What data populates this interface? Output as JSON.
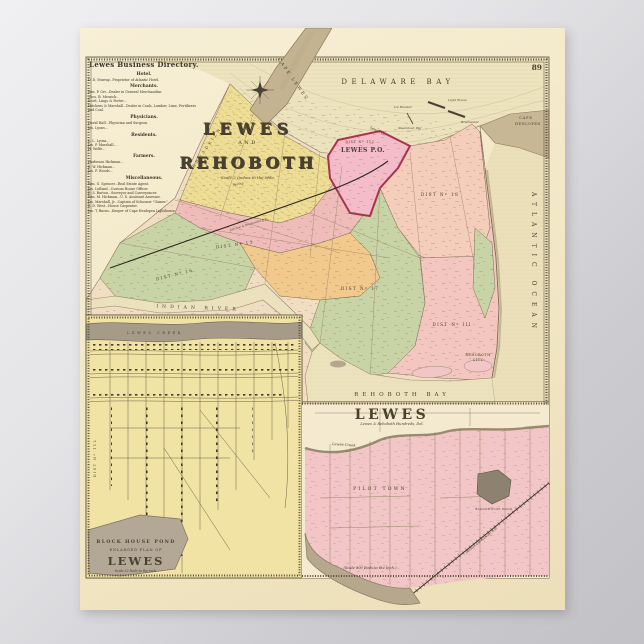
{
  "plate_number": "89",
  "colors": {
    "paper": "#f2e7c5",
    "background_gray": "#c9c9cd",
    "district_yellow": "#eedd96",
    "district_pink": "#efbcba",
    "district_peach": "#f5cdbb",
    "district_green": "#c9d4a6",
    "district_orange": "#f2c98d",
    "lewes_boundary_crimson": "#a8344f",
    "water": "#ece2bd",
    "shore_tan": "#b7aa8f",
    "ink": "#3c342a"
  },
  "directory": {
    "title": "Lewes Business Directory.",
    "sections": [
      {
        "heading": "Hotel.",
        "entries": [
          "D. D. Murray...Proprietor of Atlantic Hotel."
        ]
      },
      {
        "heading": "Merchants.",
        "entries": [
          "Wm. P. Orr...Dealer in General Merchandise.",
          "Thos. B. Messick...",
          "Scott, Lingo & Porter...",
          "Hitchens & Marshall...Dealer in Coals, Lumber, Lime, Fertilizers and Coal."
        ]
      },
      {
        "heading": "Physicians.",
        "entries": [
          "David Hall...Physician and Surgeon.",
          "Jas. Lyons..."
        ]
      },
      {
        "heading": "Residents.",
        "entries": [
          "L. L. Lyons...",
          "Jas. P. Marshall...",
          "H. Wolfe..."
        ]
      },
      {
        "heading": "Farmers.",
        "entries": [
          "Harbeson Hickman...",
          "S. W. Hickman...",
          "Jas. P. Woods..."
        ]
      },
      {
        "heading": "Miscellaneous.",
        "entries": [
          "Wm. G. Spencer...Real Estate Agent.",
          "Jas. Lofland...Custom House Officer.",
          "Z. S. Barton...Surveyor and Conveyancer.",
          "Wm. M. Hickman...U. S. Assistant Assessor.",
          "Jas. Marshall, Jr...Captain of Schooner \"Gamer.\"",
          "Z. D. West...House Carpenter.",
          "Jas. T. Burns...Keeper of Cape Henlopen Lighthouse."
        ]
      }
    ]
  },
  "main_map": {
    "title_line1": "LEWES",
    "title_line2": "AND",
    "title_line3": "REHOBOTH",
    "scale_note": "Scale 2 Inches to the Mile.",
    "labels": {
      "delaware_bay": "DELAWARE BAY",
      "cape_lewes": "CAPE LEWES",
      "cape_henlopen_1": "CAPE",
      "cape_henlopen_2": "HENLOPEN",
      "ice_breaker": "Ice Breaker",
      "breakwater": "Breakwater",
      "light_house": "Light House",
      "steamboat_pier": "Steamboat Pier",
      "lewes_creek": "Lewes Cr.",
      "spring": "Spring",
      "broadkiln": "BROADKILN",
      "lewes_po": "LEWES P.O.",
      "dist_112": "DIST Nº 112",
      "dist_18": "DIST Nº 18",
      "dist_13": "DIST Nº 13",
      "dist_16": "DIST Nº 16",
      "dist_17": "DIST Nº 17",
      "dist_iii": "DIST Nº III",
      "railroad": "Junction & Breakwater R.R.",
      "indian_river": "INDIAN RIVER",
      "rehoboth_bay": "REHOBOTH BAY",
      "rehoboth_city_1": "REHOBOTH",
      "rehoboth_city_2": "CITY",
      "atlantic_ocean": "ATLANTIC OCEAN"
    }
  },
  "inset_town_plan": {
    "creek_label": "LEWES CREEK",
    "district_label": "DIST Nº 112",
    "pond_label": "BLOCK HOUSE POND",
    "subtitle": "ENLARGED PLAN OF",
    "title": "LEWES",
    "scale_note": "Scale 32 Rods to the Inch."
  },
  "inset_hundreds": {
    "title": "LEWES",
    "subtitle": "Lewes & Rehoboth Hundreds, Del.",
    "creek_label": "Lewes Creek",
    "pilot_town": "PILOT TOWN",
    "pond_label": "BLOCKHOUSE POND",
    "railroad_label": "Junction & Breakwater R.R.",
    "scale_note": "(Scale 800 Rods to the Inch.)"
  }
}
